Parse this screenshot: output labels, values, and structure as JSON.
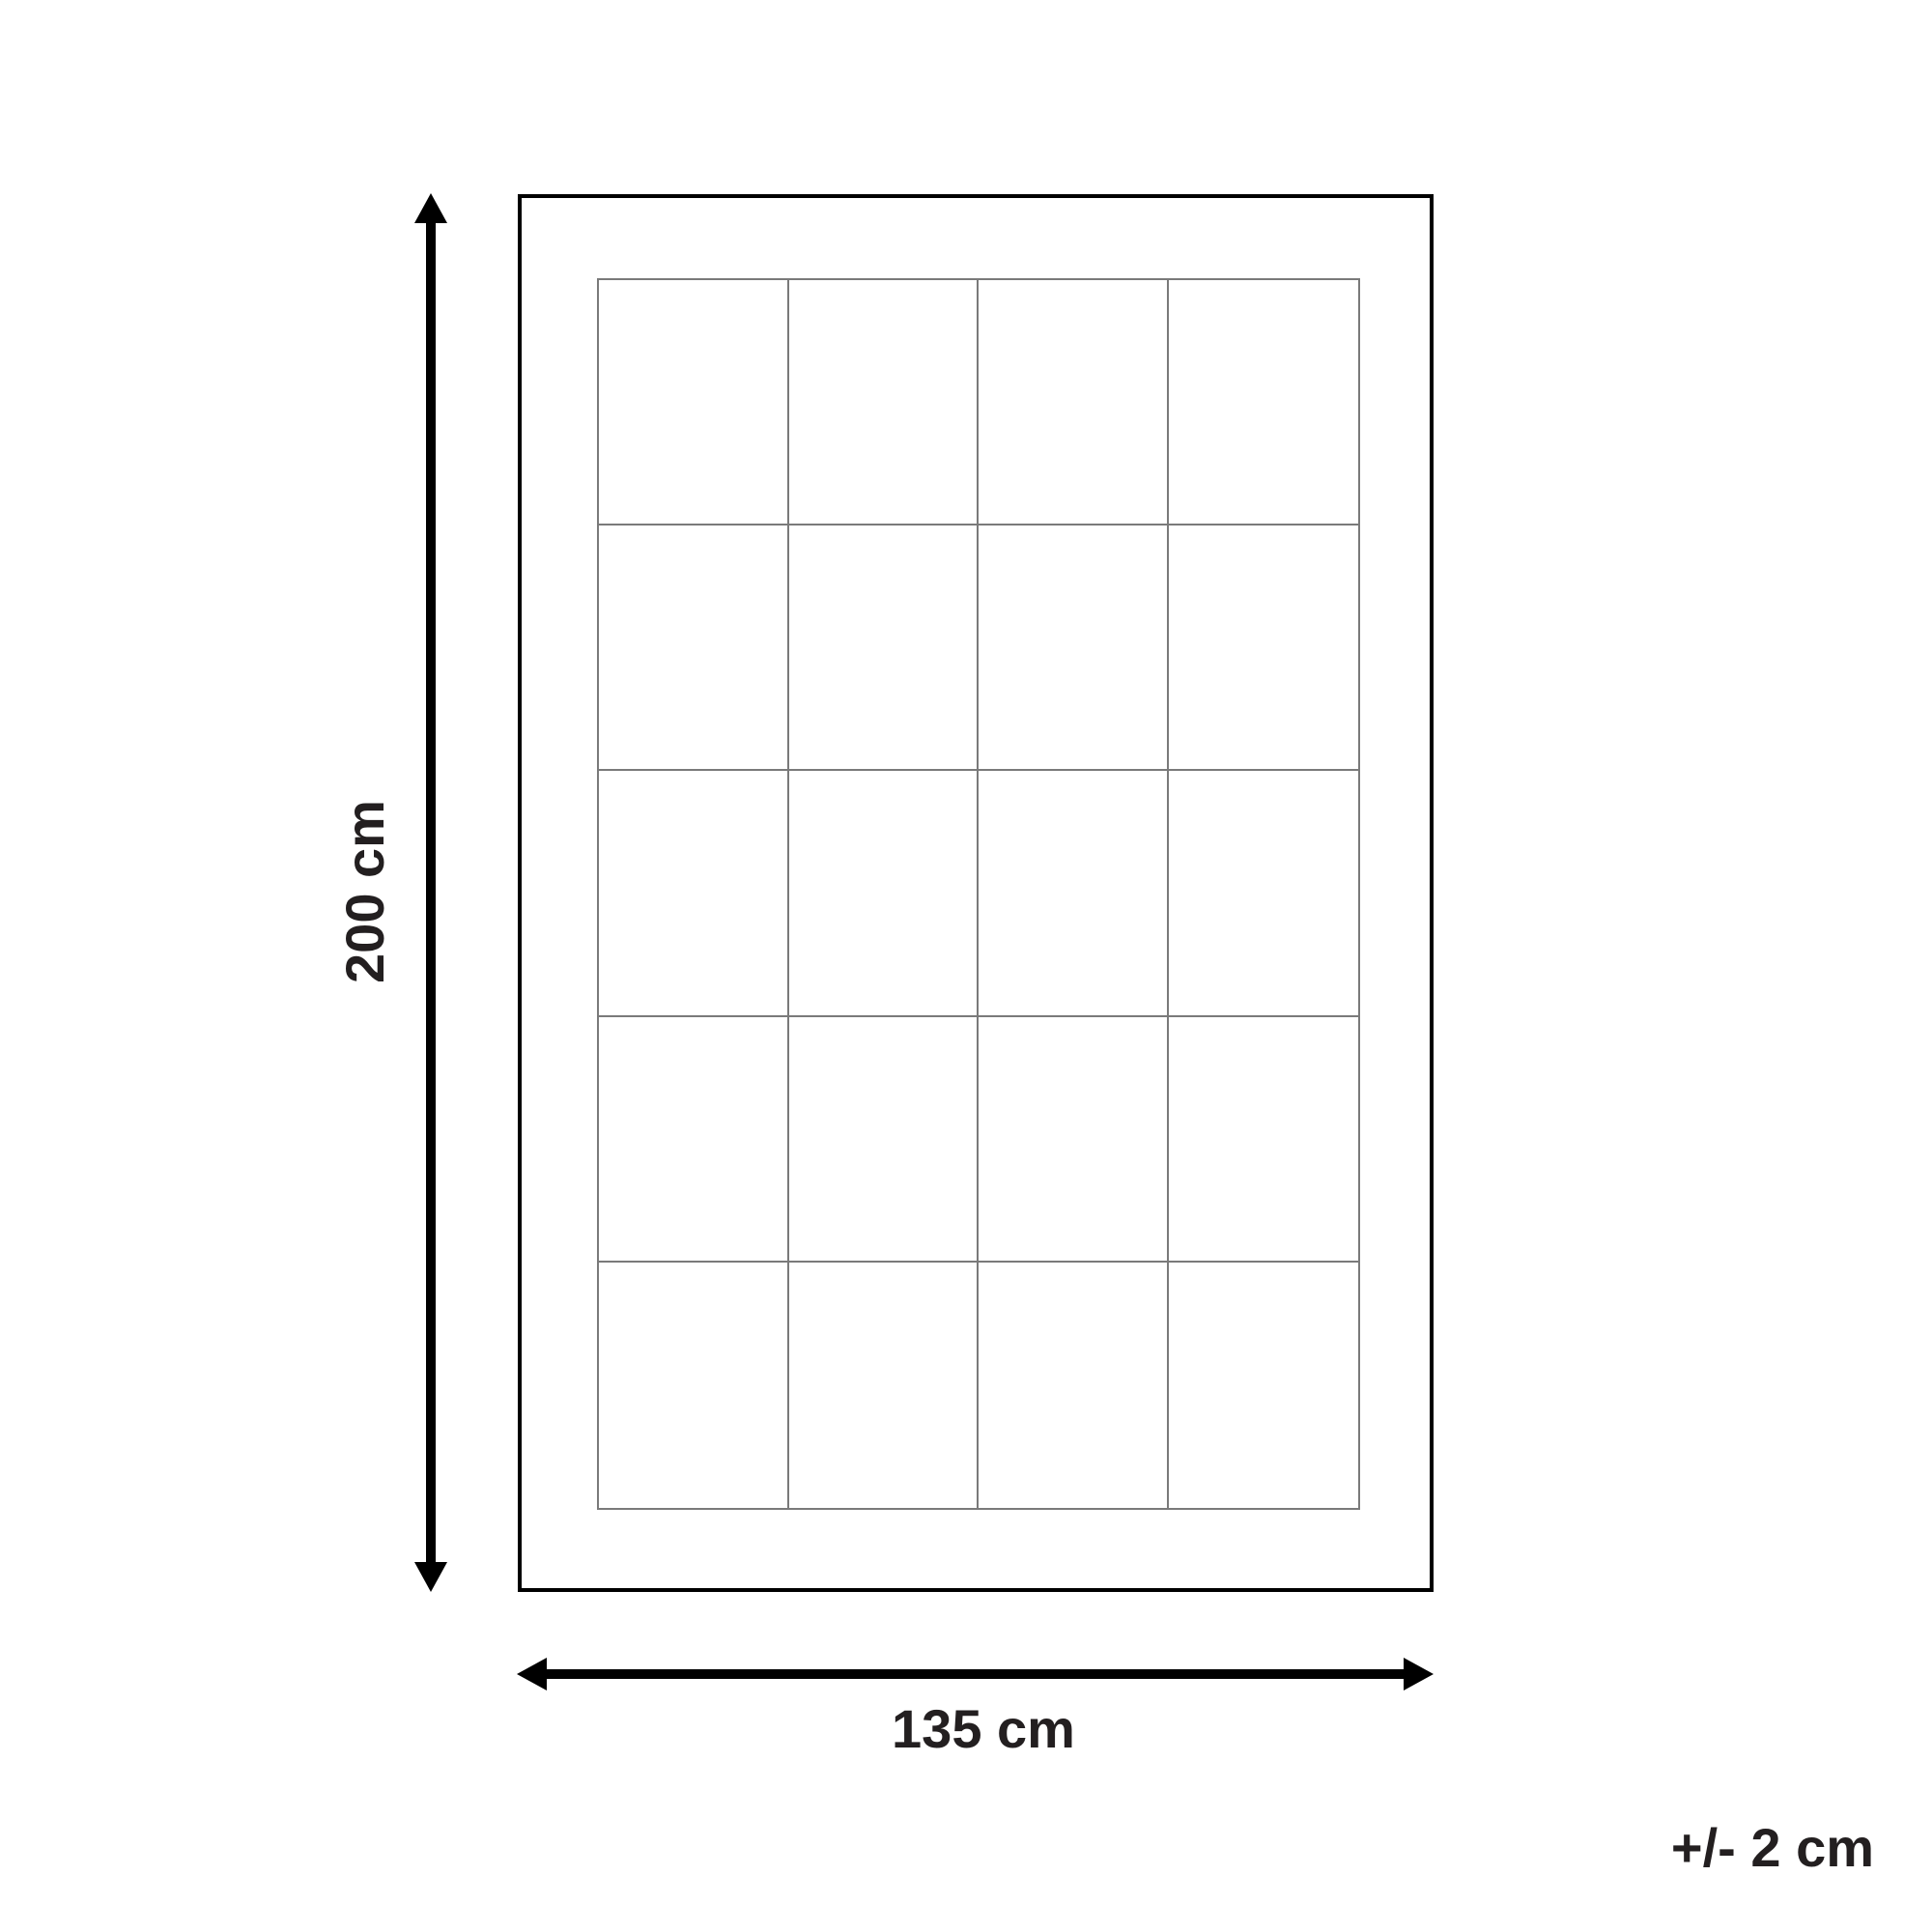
{
  "diagram": {
    "height_label": "200 cm",
    "width_label": "135 cm",
    "tolerance_label": "+/- 2 cm",
    "grid": {
      "rows": 5,
      "columns": 4
    },
    "colors": {
      "background": "#ffffff",
      "outline": "#000000",
      "grid_line": "#7a7a7a",
      "arrow": "#000000",
      "text": "#231f20"
    }
  }
}
